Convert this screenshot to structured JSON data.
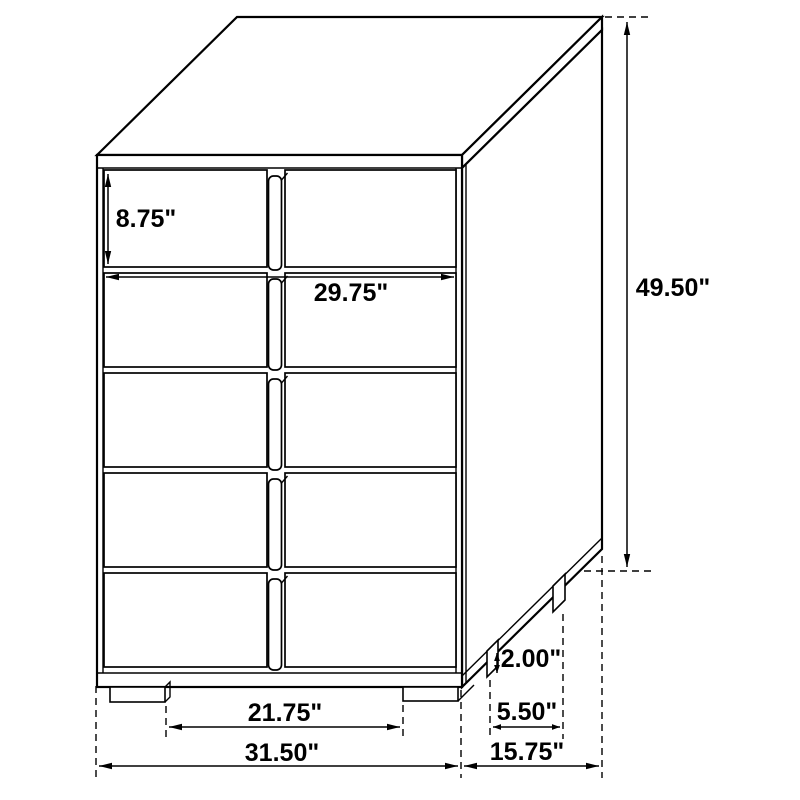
{
  "diagram": {
    "title": "5-drawer chest dimensional line drawing, three-quarter view",
    "colors": {
      "background": "#ffffff",
      "line": "#000000",
      "text": "#000000"
    },
    "figure": {
      "type": "furniture-dimension-diagram",
      "drawer_rows": 5,
      "drawer_columns": 2
    },
    "dimensions": {
      "top_drawer_height": "8.75\"",
      "front_inner_width": "29.75\"",
      "overall_height": "49.50\"",
      "foot_height": "2.00\"",
      "front_foot_spacing": "21.75\"",
      "side_foot_spacing": "5.50\"",
      "overall_width": "31.50\"",
      "overall_depth": "15.75\""
    }
  }
}
